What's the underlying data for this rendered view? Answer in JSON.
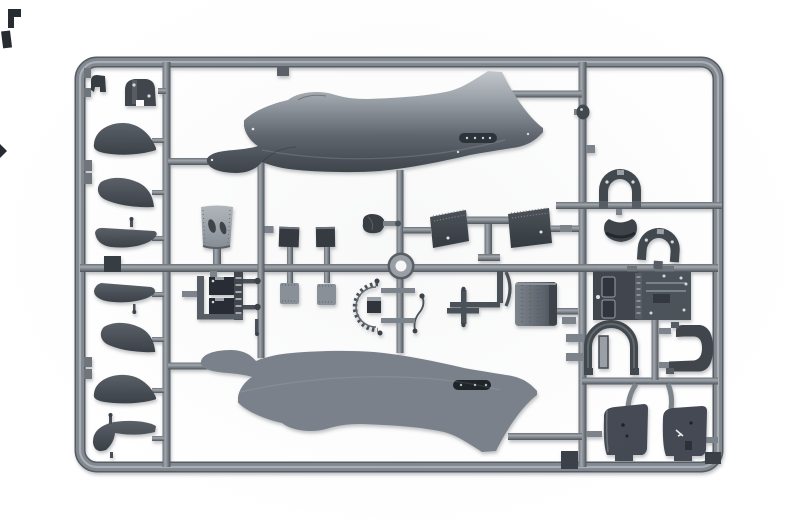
{
  "scene": {
    "type": "product-photo",
    "subject": "injection-molded plastic model kit sprue with racing seaplane parts",
    "background": "plain white studio background",
    "text_visible": "none"
  },
  "palette": {
    "bg": "#ffffff",
    "frame-mid": "#82888f",
    "frame-dark": "#565c63",
    "frame-light": "#a9aeb4",
    "part-dark": "#363c43",
    "part-slate": "#454b52",
    "part-mid": "#5b6169",
    "part-light": "#9aa0a7",
    "part-lighter": "#b7bcc2",
    "part-deep": "#272c32",
    "shadow": "rgba(95,100,106,0.38)"
  },
  "sprue": {
    "frame": {
      "label": "outer sprue frame, rounded rectangle"
    },
    "runners": [
      {
        "id": "left-runner",
        "label": "left vertical runner"
      },
      {
        "id": "right-runner",
        "label": "right vertical runner"
      },
      {
        "id": "mid-runner",
        "label": "middle horizontal runner"
      },
      {
        "id": "center-runner-1",
        "label": "center vertical runner (cone/engine column)"
      },
      {
        "id": "ring-runner",
        "label": "center vertical runner through ring"
      },
      {
        "id": "t-runner",
        "label": "T-shaped runner for radiator slabs"
      },
      {
        "id": "fin-runner-top",
        "label": "runner from upper fuselage fin"
      },
      {
        "id": "fin-runner-bottom",
        "label": "runner from lower fuselage fin"
      },
      {
        "id": "right-cell-runner-1",
        "label": "right cell upper horizontal runner"
      },
      {
        "id": "right-cell-runner-2",
        "label": "right cell lower horizontal runner"
      }
    ],
    "parts": [
      {
        "id": "fuselage-half-upper",
        "label": "fuselage half, nose left, fin up (light gray)"
      },
      {
        "id": "fuselage-half-lower",
        "label": "fuselage half, mirrored, fin down (dark charcoal)"
      },
      {
        "id": "nose-cap",
        "label": "small cap part, top-left"
      },
      {
        "id": "tail-cap",
        "label": "rounded cap with two holes"
      },
      {
        "id": "blade-1",
        "label": "blade / fin shaped part"
      },
      {
        "id": "blade-2",
        "label": "blade / fin shaped part"
      },
      {
        "id": "float-half-1",
        "label": "flat-top float part"
      },
      {
        "id": "junction-block",
        "label": "small dark block on runner"
      },
      {
        "id": "float-half-2",
        "label": "boat-shaped float part"
      },
      {
        "id": "blade-3",
        "label": "blade / fin shaped part"
      },
      {
        "id": "blade-4",
        "label": "blade / fin shaped part"
      },
      {
        "id": "float-half-3",
        "label": "hull-shaped float part with pins"
      },
      {
        "id": "cowling-cone",
        "label": "tapered cowling with two oval openings"
      },
      {
        "id": "firewall-panel-1",
        "label": "small dark square panel"
      },
      {
        "id": "firewall-panel-2",
        "label": "small dark square panel"
      },
      {
        "id": "radiator-panel-1",
        "label": "small light riveted panel"
      },
      {
        "id": "radiator-panel-2",
        "label": "small light riveted panel"
      },
      {
        "id": "spinner-scoop",
        "label": "small dark scoop with pin"
      },
      {
        "id": "center-ring",
        "label": "ring / donut shaped part at sprue center"
      },
      {
        "id": "radiator-slab-1",
        "label": "large angled radiator slab"
      },
      {
        "id": "radiator-slab-2",
        "label": "large angled radiator slab"
      },
      {
        "id": "engine-block",
        "label": "engine block assembly with ball-end pushrods"
      },
      {
        "id": "exhaust-quadrant",
        "label": "segmented quarter-arc part with tick marks"
      },
      {
        "id": "control-stick",
        "label": "bent rod with cross piece"
      },
      {
        "id": "oil-tank-drum",
        "label": "cylindrical drum with rivet rows"
      },
      {
        "id": "engine-bearer-arch-1",
        "label": "horseshoe arch bracket"
      },
      {
        "id": "engine-bearer-arch-2",
        "label": "horseshoe arch bracket"
      },
      {
        "id": "headrest-saddle",
        "label": "saddle / cup shaped part"
      },
      {
        "id": "cockpit-deck",
        "label": "rectangular deck plate with slots and bolts"
      },
      {
        "id": "bulkhead-arch",
        "label": "dome arch with inner slat"
      },
      {
        "id": "mount-bracket",
        "label": "C-shaped bracket"
      },
      {
        "id": "cowl-panel-1",
        "label": "curved cowling panel with tabs"
      },
      {
        "id": "cowl-panel-2",
        "label": "curved cowling panel with tabs"
      },
      {
        "id": "sprue-pad-1",
        "label": "dark pad on bottom runner"
      },
      {
        "id": "sprue-pad-2",
        "label": "dark pad at bottom-right corner"
      },
      {
        "id": "stray-part-1",
        "label": "cropped dark part at photo top-left edge"
      },
      {
        "id": "stray-part-2",
        "label": "cropped dark part at photo top-left edge"
      },
      {
        "id": "stray-part-3",
        "label": "cropped dark wedge at photo left edge"
      }
    ]
  }
}
